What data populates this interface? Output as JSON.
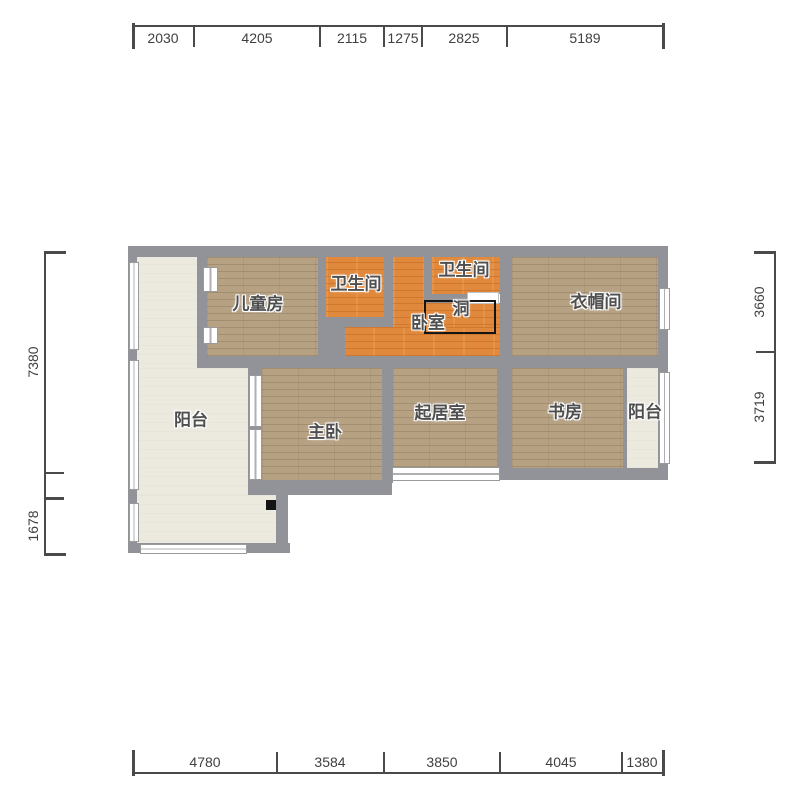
{
  "title": "floor-plan",
  "colors": {
    "wall": "#919398",
    "floor_wood": "#b6a183",
    "floor_orange": "#e0883b",
    "floor_balcony": "#eceadf",
    "annotation_text": "#3f3f3f",
    "hole_outline": "#141414"
  },
  "rooms": {
    "balcony_left": {
      "label": "阳台"
    },
    "children": {
      "label": "儿童房"
    },
    "bath_left": {
      "label": "卫生间"
    },
    "bath_right": {
      "label": "卫生间"
    },
    "bedroom": {
      "label": "卧室"
    },
    "hole": {
      "label": "洞"
    },
    "cloakroom": {
      "label": "衣帽间"
    },
    "master": {
      "label": "主卧"
    },
    "living": {
      "label": "起居室"
    },
    "study": {
      "label": "书房"
    },
    "balcony_right": {
      "label": "阳台"
    }
  },
  "dimensions": {
    "top": [
      "2030",
      "4205",
      "2115",
      "1275",
      "2825",
      "5189"
    ],
    "bottom": [
      "4780",
      "3584",
      "3850",
      "4045",
      "1380"
    ],
    "left": [
      "7380",
      "1678"
    ],
    "right": [
      "3660",
      "3719"
    ]
  }
}
